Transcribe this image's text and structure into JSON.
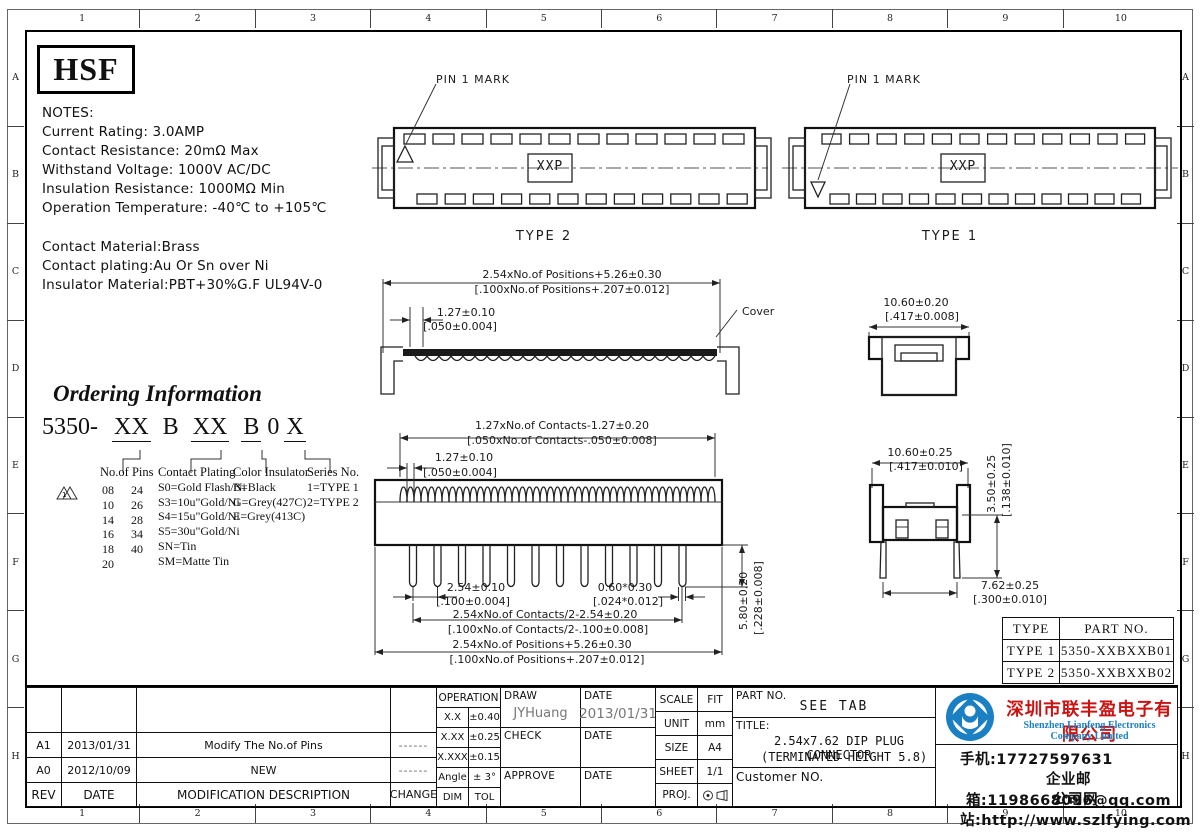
{
  "ruler": {
    "cols": [
      "1",
      "2",
      "3",
      "4",
      "5",
      "6",
      "7",
      "8",
      "9",
      "10"
    ],
    "rows": [
      "A",
      "B",
      "C",
      "D",
      "E",
      "F",
      "G",
      "H"
    ]
  },
  "logo_text": "HSF",
  "notes": {
    "heading": "NOTES:",
    "lines": [
      "Current Rating: 3.0AMP",
      "Contact Resistance: 20mΩ Max",
      "Withstand Voltage: 1000V AC/DC",
      "Insulation Resistance: 1000MΩ Min",
      "Operation Temperature: -40℃ to +105℃"
    ],
    "material_lines": [
      "Contact Material:Brass",
      "Contact plating:Au Or Sn over Ni",
      "Insulator Material:PBT+30%G.F UL94V-0"
    ]
  },
  "top_views": {
    "pin_mark_label": "PIN 1 MARK",
    "center_label": "XXP",
    "type2_caption": "TYPE 2",
    "type1_caption": "TYPE 1"
  },
  "cover_view": {
    "dim_width_mm": "2.54xNo.of Positions+5.26±0.30",
    "dim_width_in": "[.100xNo.of Positions+.207±0.012]",
    "dim_pitch_mm": "1.27±0.10",
    "dim_pitch_in": "[.050±0.004]",
    "cover_label": "Cover",
    "side_dim_mm": "10.60±0.20",
    "side_dim_in": "[.417±0.008]"
  },
  "ordering": {
    "title": "Ordering Information",
    "prefix": "5350-",
    "seg1": "XX",
    "seg2": "B",
    "seg3": "XX",
    "seg4": "B",
    "seg5": "0",
    "seg6": "X",
    "pins": {
      "header": "No.of Pins",
      "marker": "1",
      "col1": [
        "08",
        "10",
        "14",
        "16",
        "18",
        "20"
      ],
      "col2": [
        "24",
        "26",
        "28",
        "34",
        "40"
      ]
    },
    "plating": {
      "header": "Contact Plating",
      "lines": [
        "S0=Gold Flash/Ni",
        "S3=10u\"Gold/Ni",
        "S4=15u\"Gold/Ni",
        "S5=30u\"Gold/Ni",
        "SN=Tin",
        "SM=Matte Tin"
      ]
    },
    "insulator": {
      "header": "Color Insulator",
      "lines": [
        "B=Black",
        "G=Grey(427C)",
        "E=Grey(413C)"
      ]
    },
    "series": {
      "header": "Series No.",
      "lines": [
        "1=TYPE 1",
        "2=TYPE 2"
      ]
    }
  },
  "main_view": {
    "dim_contacts_mm": "1.27xNo.of Contacts-1.27±0.20",
    "dim_contacts_in": "[.050xNo.of Contacts-.050±0.008]",
    "dim_pitch_mm": "1.27±0.10",
    "dim_pitch_in": "[.050±0.004]",
    "dim_pin_pitch_mm": "2.54±0.10",
    "dim_pin_pitch_in": "[.100±0.004]",
    "dim_pin_w_mm": "0.60*0.30",
    "dim_pin_w_in": "[.024*0.012]",
    "dim_row_mm": "2.54xNo.of Contacts/2-2.54±0.20",
    "dim_row_in": "[.100xNo.of Contacts/2-.100±0.008]",
    "dim_total_mm": "2.54xNo.of Positions+5.26±0.30",
    "dim_total_in": "[.100xNo.of Positions+.207±0.012]",
    "dim_height_mm": "5.80±0.20",
    "dim_height_in": "[.228±0.008]"
  },
  "side_view": {
    "dim_width_mm": "10.60±0.25",
    "dim_width_in": "[.417±0.010]",
    "dim_h_mm": "3.50±0.25",
    "dim_h_in": "[.138±0.010]",
    "dim_span_mm": "7.62±0.25",
    "dim_span_in": "[.300±0.010]"
  },
  "part_table": {
    "col1": "TYPE",
    "col2": "PART NO.",
    "rows": [
      [
        "TYPE 1",
        "5350-XXBXXB01"
      ],
      [
        "TYPE 2",
        "5350-XXBXXB02"
      ]
    ]
  },
  "title_block": {
    "rev_rows": [
      {
        "rev": "A1",
        "date": "2013/01/31",
        "desc": "Modify The No.of Pins",
        "change": "------"
      },
      {
        "rev": "A0",
        "date": "2012/10/09",
        "desc": "NEW",
        "change": "------"
      }
    ],
    "rev_header": {
      "rev": "REV",
      "date": "DATE",
      "desc": "MODIFICATION  DESCRIPTION",
      "change": "CHANGE"
    },
    "operation": {
      "header": "OPERATION",
      "rows": [
        [
          "X.X",
          "±0.40"
        ],
        [
          "X.XX",
          "±0.25"
        ],
        [
          "X.XXX",
          "±0.15"
        ],
        [
          "Angle",
          "± 3°"
        ],
        [
          "DIM",
          "TOL"
        ]
      ]
    },
    "sign": {
      "draw_label": "DRAW",
      "draw_name": "JYHuang",
      "draw_date_label": "DATE",
      "draw_date": "2013/01/31",
      "check_label": "CHECK",
      "check_date_label": "DATE",
      "approve_label": "APPROVE",
      "approve_date_label": "DATE"
    },
    "info": {
      "scale_label": "SCALE",
      "scale": "FIT",
      "unit_label": "UNIT",
      "unit": "mm",
      "size_label": "SIZE",
      "size": "A4",
      "sheet_label": "SHEET",
      "sheet": "1/1",
      "proj_label": "PROJ."
    },
    "part_no_label": "PART NO.",
    "part_no": "SEE TAB",
    "title_label": "TITLE:",
    "title_line1": "2.54x7.62 DIP PLUG CONNECTOR",
    "title_line2": "(TERMINATED HEIGHT 5.8)",
    "customer_label": "Customer NO."
  },
  "company": {
    "name_cn": "深圳市联丰盈电子有限公司",
    "name_en": "Shenzhen Lianfeng Electronics Company Limited",
    "phone": "手机:17727597631",
    "email": "企业邮箱:1198668096@qq.com",
    "website": "公司网站:http://www.szlfying.com",
    "brand_red": "#cc1111",
    "brand_blue": "#1b7fc3"
  }
}
